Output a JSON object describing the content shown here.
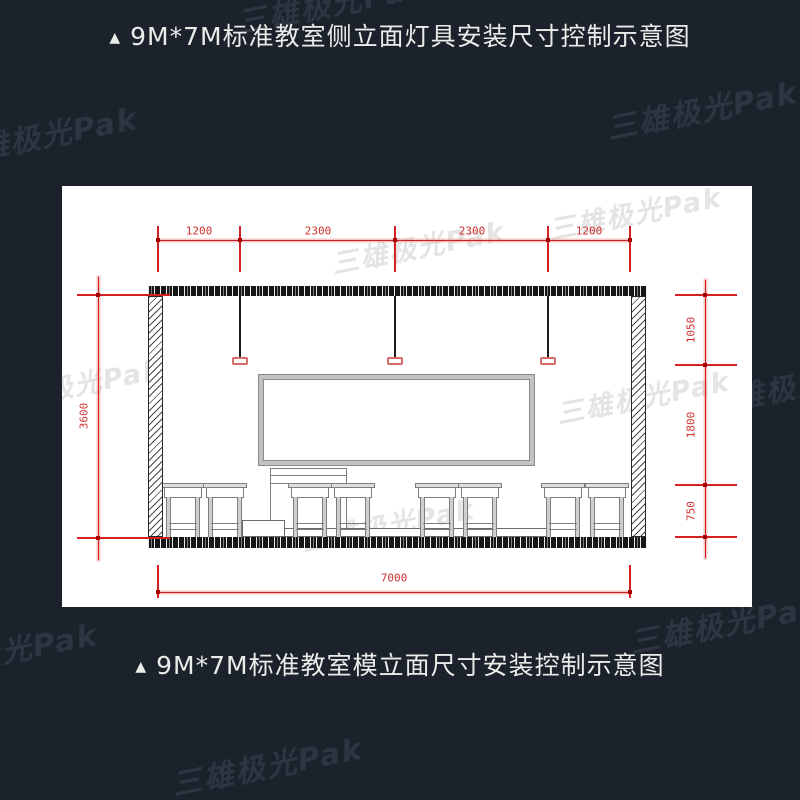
{
  "background": "#1c222b",
  "panel_bg": "#ffffff",
  "titles": {
    "top_marker": "▲",
    "top": "9M*7M标准教室侧立面灯具安装尺寸控制示意图",
    "bottom_marker": "▲",
    "bottom": "9M*7M标准教室模立面尺寸安装控制示意图"
  },
  "watermark": {
    "text": "三雄极光Pak"
  },
  "colors": {
    "dimension_red": "#d01d1d",
    "lamp_fixture_red": "#d96b6b",
    "title_text": "#e9ede9",
    "watermark_dark": "#2e3540",
    "watermark_light": "#e4e4e4"
  },
  "dims": {
    "top": [
      "1200",
      "2300",
      "2300",
      "1200"
    ],
    "left": "3600",
    "right": [
      "1050",
      "1800",
      "750"
    ],
    "bottom": "7000"
  }
}
